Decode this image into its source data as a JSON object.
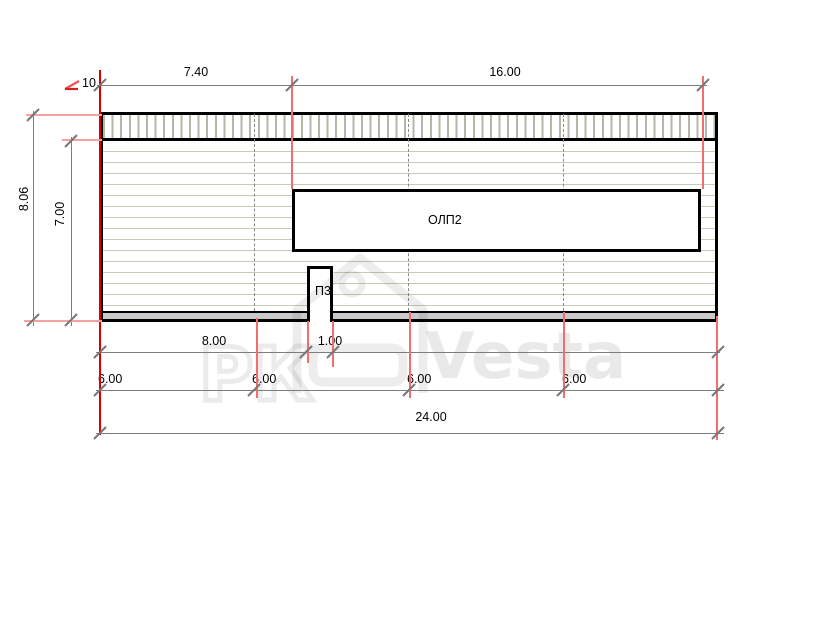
{
  "drawing": {
    "slope": "10",
    "objects": {
      "olp2": "ОЛП2",
      "p3": "П3"
    },
    "dims": {
      "top": [
        "7.40",
        "16.00"
      ],
      "left": [
        "8.06",
        "7.00"
      ],
      "row1": [
        "8.00",
        "1.00"
      ],
      "row2": [
        "6.00",
        "6.00",
        "6.00",
        "6.00"
      ],
      "total": "24.00"
    },
    "colors": {
      "extension_red_strong": "#d90000",
      "extension_red": "#f26d6d",
      "extension_red_light": "#f7a0a0",
      "dimension_gray": "#7d7d7d",
      "hatch_olive": "#b3b9a6",
      "siding_olive": "#c6ccba",
      "base_gray": "#c9c9c9"
    }
  },
  "watermark": {
    "left": "РК",
    "right": "Vesta"
  }
}
